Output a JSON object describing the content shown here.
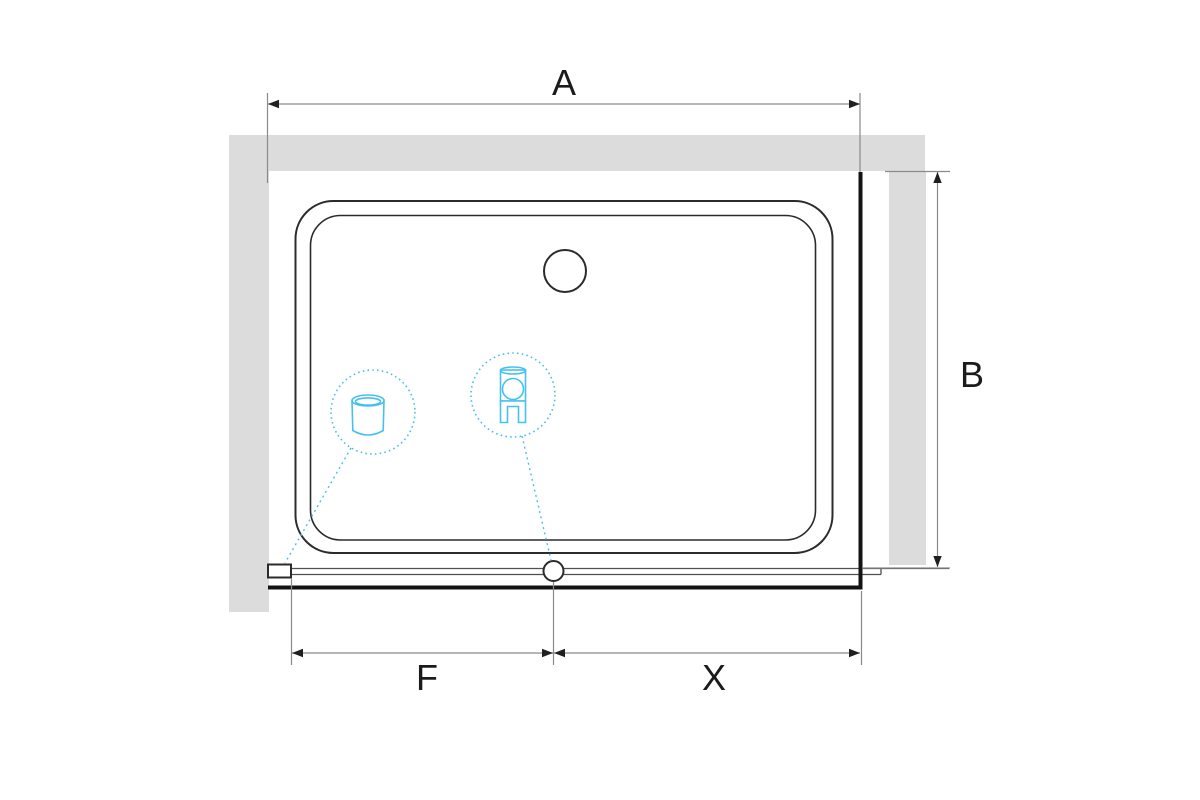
{
  "drawing": {
    "title": "shower-enclosure-plan-view",
    "dimensions": {
      "a": {
        "label": "A"
      },
      "b": {
        "label": "B"
      },
      "f": {
        "label": "F"
      },
      "x": {
        "label": "X"
      }
    },
    "callouts": [
      {
        "name": "drain-detail",
        "icon": "waste-cylinder-icon"
      },
      {
        "name": "roller-detail",
        "icon": "roller-bracket-icon"
      }
    ],
    "colors": {
      "wall_gray": "#dcdcdc",
      "ink": "#2b2b2b",
      "thick_ink": "#131313",
      "dim_gray": "#8a8a8a",
      "accent_cyan": "#46c1ef",
      "label_ink": "#1b1b1b"
    }
  }
}
